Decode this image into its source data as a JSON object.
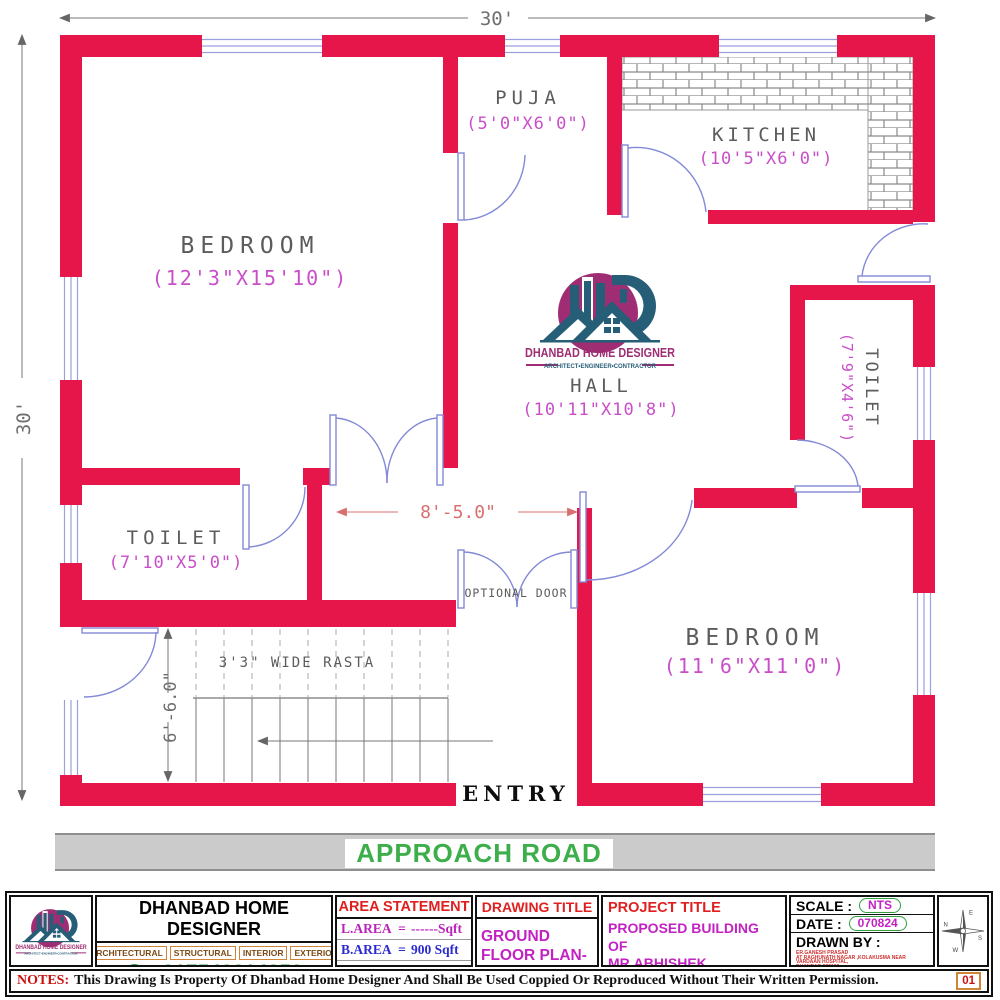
{
  "logo": {
    "name": "DHANBAD HOME DESIGNER",
    "tagline": "ARCHITECT•ENGINEER•CONTRACTOR"
  },
  "plan": {
    "colors": {
      "wall": "#e6164b",
      "opening": "#8289d6",
      "dim_text": "#c94fc9",
      "room_text": "#5c5c5c"
    },
    "dims": {
      "top": "30'",
      "left": "30'",
      "hall": "8'-5.0\"",
      "stairs": "6'-6.0\""
    },
    "rooms": {
      "bedroom_tl": {
        "name": "BEDROOM",
        "size": "(12'3\"X15'10\")"
      },
      "puja": {
        "name": "PUJA",
        "size": "(5'0\"X6'0\")"
      },
      "kitchen": {
        "name": "KITCHEN",
        "size": "(10'5\"X6'0\")"
      },
      "hall": {
        "name": "HALL",
        "size": "(10'11\"X10'8\")"
      },
      "toilet_right": {
        "name": "TOILET",
        "size": "(7'9\"X4'6\")"
      },
      "toilet_left": {
        "name": "TOILET",
        "size": "(7'10\"X5'0\")"
      },
      "bedroom_br": {
        "name": "BEDROOM",
        "size": "(11'6\"X11'0\")"
      }
    },
    "labels": {
      "rasta": "3'3\" WIDE RASTA",
      "optional_door": "OPTIONAL DOOR",
      "entry": "ENTRY",
      "road": "APPROACH ROAD"
    }
  },
  "title_block": {
    "company": {
      "name": "DHANBAD HOME DESIGNER",
      "tags": [
        "ARCHITECTURAL",
        "STRUCTURAL",
        "INTERIOR",
        "EXTERIOR"
      ],
      "phone": "+917543814258",
      "website": "www.dhanbadhomedesigner.in"
    },
    "area": {
      "title": "AREA STATEMENT",
      "rows": [
        {
          "label": "L.AREA",
          "eq": "=",
          "value": "------Sqft"
        },
        {
          "label": "B.AREA",
          "eq": "=",
          "value": "900 Sqft"
        },
        {
          "label": "T.AREA",
          "eq": "=",
          "value": "900 Sqft"
        }
      ]
    },
    "drawing": {
      "title": "DRAWING TITLE",
      "value": "GROUND FLOOR PLAN-3"
    },
    "project": {
      "title": "PROJECT TITLE",
      "lines": [
        "PROPOSED BUILDING OF",
        "MR.ABHISHEK PARMANIK",
        "KATRAS,DHANBAD"
      ]
    },
    "meta": {
      "scale_label": "SCALE :",
      "scale": "NTS",
      "date_label": "DATE :",
      "date": "070824",
      "drawn_label": "DRAWN BY :",
      "address": [
        "ER.GANESH PRASAD",
        "AT RAGHUNATH NAGAR ,KOLAKUSMA NEAR VARDAAN HOSPITAL,",
        "DHANBAD 828109",
        "CONTACT NO. 7543814258,7739256595",
        "EMAIL ID. ganeshpd44@gmail.com",
        "WEBSITE : dhanbadhomedesigner.in"
      ]
    },
    "compass": {
      "n": "N",
      "e": "E",
      "s": "S",
      "w": "W"
    },
    "sheet": "01",
    "notes": {
      "label": "NOTES:",
      "text": "This Drawing Is Property Of Dhanbad Home Designer And Shall Be Used Coppied Or Reproduced Without Their Written Permission."
    }
  }
}
